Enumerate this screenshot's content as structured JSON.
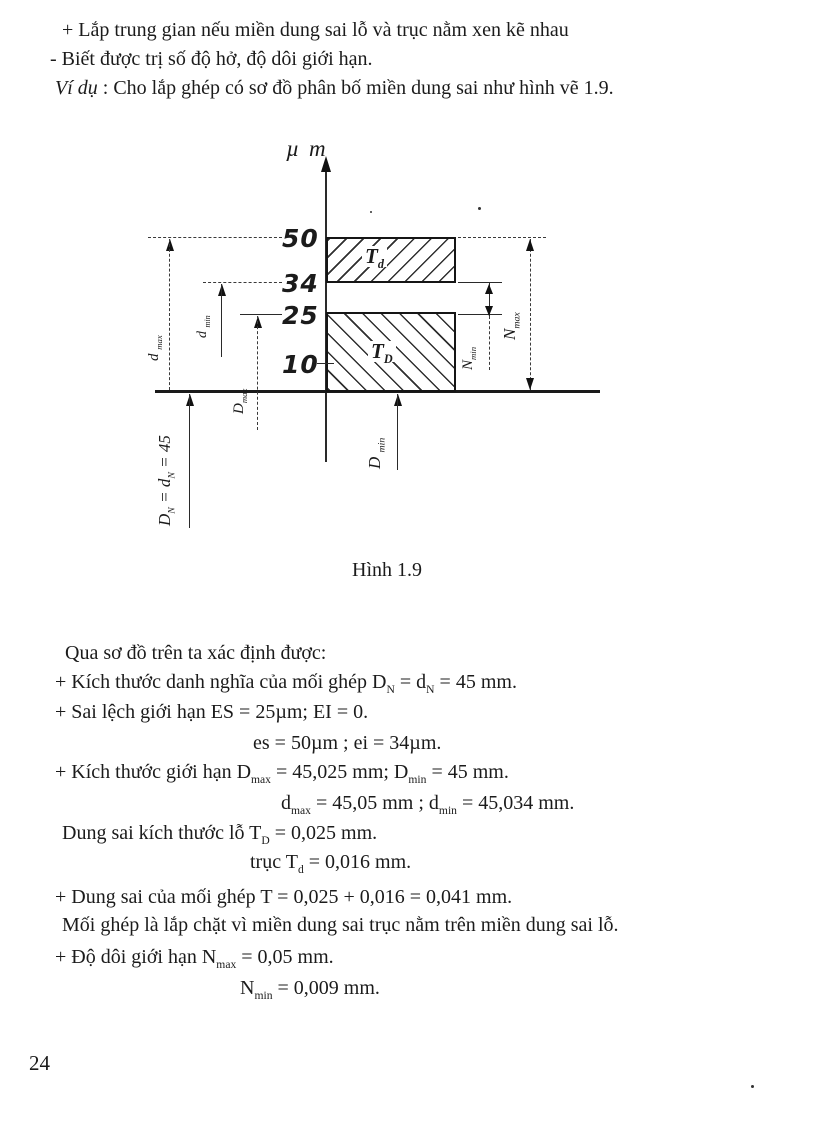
{
  "page_number": "24",
  "intro": {
    "line1": "+ Lắp trung gian nếu miền dung sai lỗ và trục nằm xen kẽ nhau",
    "line2": "- Biết được trị số độ hở, độ dôi giới hạn.",
    "line3_lead": "Ví dụ",
    "line3_rest": " : Cho lắp ghép có sơ đồ phân bố miền dung sai như hình vẽ 1.9."
  },
  "figure": {
    "caption": "Hình 1.9",
    "axis_unit": "µ m",
    "ticks": {
      "t50": "50",
      "t34": "34",
      "t25": "25",
      "t10": "10"
    },
    "zones": {
      "shaft": {
        "name": "Td",
        "upper_um": 50,
        "lower_um": 34
      },
      "hole": {
        "name": "TD",
        "upper_um": 25,
        "lower_um": 0
      }
    },
    "labels": {
      "td": [
        {
          "text": "T"
        },
        {
          "sub": "d"
        }
      ],
      "tD": [
        {
          "text": "T"
        },
        {
          "sub": "D"
        }
      ],
      "dmax": [
        {
          "text": "d "
        },
        {
          "sub": "max"
        }
      ],
      "dmin": [
        {
          "text": "d "
        },
        {
          "sub": "min"
        }
      ],
      "Dmax": [
        {
          "text": "D"
        },
        {
          "sub": "max"
        }
      ],
      "DN": [
        {
          "text": "D"
        },
        {
          "sub": "N"
        },
        {
          "text": " = d"
        },
        {
          "sub": "N"
        },
        {
          "text": " = 45"
        }
      ],
      "Dmin": [
        {
          "text": "D "
        },
        {
          "sub": "min"
        }
      ],
      "Nmin": [
        {
          "text": "N"
        },
        {
          "sub": "min"
        }
      ],
      "Nmax": [
        {
          "text": "N"
        },
        {
          "sub": "max"
        }
      ]
    }
  },
  "body": {
    "lines": [
      {
        "segments": [
          {
            "text": "Qua sơ đồ trên ta xác định được:"
          }
        ]
      },
      {
        "segments": [
          {
            "text": "+ Kích thước danh nghĩa của mối ghép D"
          },
          {
            "sub": "N"
          },
          {
            "text": " = d"
          },
          {
            "sub": "N"
          },
          {
            "text": " = 45 mm."
          }
        ]
      },
      {
        "segments": [
          {
            "text": "+ Sai lệch giới hạn ES = 25µm; EI = 0."
          }
        ]
      },
      {
        "segments": [
          {
            "text": "es = 50µm ; ei = 34µm."
          }
        ]
      },
      {
        "segments": [
          {
            "text": "+ Kích thước giới hạn D"
          },
          {
            "sub": "max"
          },
          {
            "text": " = 45,025 mm; D"
          },
          {
            "sub": "min"
          },
          {
            "text": " = 45 mm."
          }
        ]
      },
      {
        "segments": [
          {
            "text": "d"
          },
          {
            "sub": "max"
          },
          {
            "text": " = 45,05 mm ; d"
          },
          {
            "sub": "min"
          },
          {
            "text": " = 45,034 mm."
          }
        ]
      },
      {
        "segments": [
          {
            "text": "Dung sai kích thước lỗ T"
          },
          {
            "sub": "D"
          },
          {
            "text": " = 0,025 mm."
          }
        ]
      },
      {
        "segments": [
          {
            "text": "trục T"
          },
          {
            "sub": "d"
          },
          {
            "text": " = 0,016 mm."
          }
        ]
      },
      {
        "segments": [
          {
            "text": "+ Dung sai của mối ghép T = 0,025 + 0,016 = 0,041 mm."
          }
        ]
      },
      {
        "segments": [
          {
            "text": "Mối ghép là lắp chặt vì miền dung sai trục nằm trên miền dung sai lỗ."
          }
        ]
      },
      {
        "segments": [
          {
            "text": "+ Độ dôi giới hạn N"
          },
          {
            "sub": "max"
          },
          {
            "text": " = 0,05 mm."
          }
        ]
      },
      {
        "segments": [
          {
            "text": "N"
          },
          {
            "sub": "min"
          },
          {
            "text": " = 0,009 mm."
          }
        ]
      }
    ]
  }
}
